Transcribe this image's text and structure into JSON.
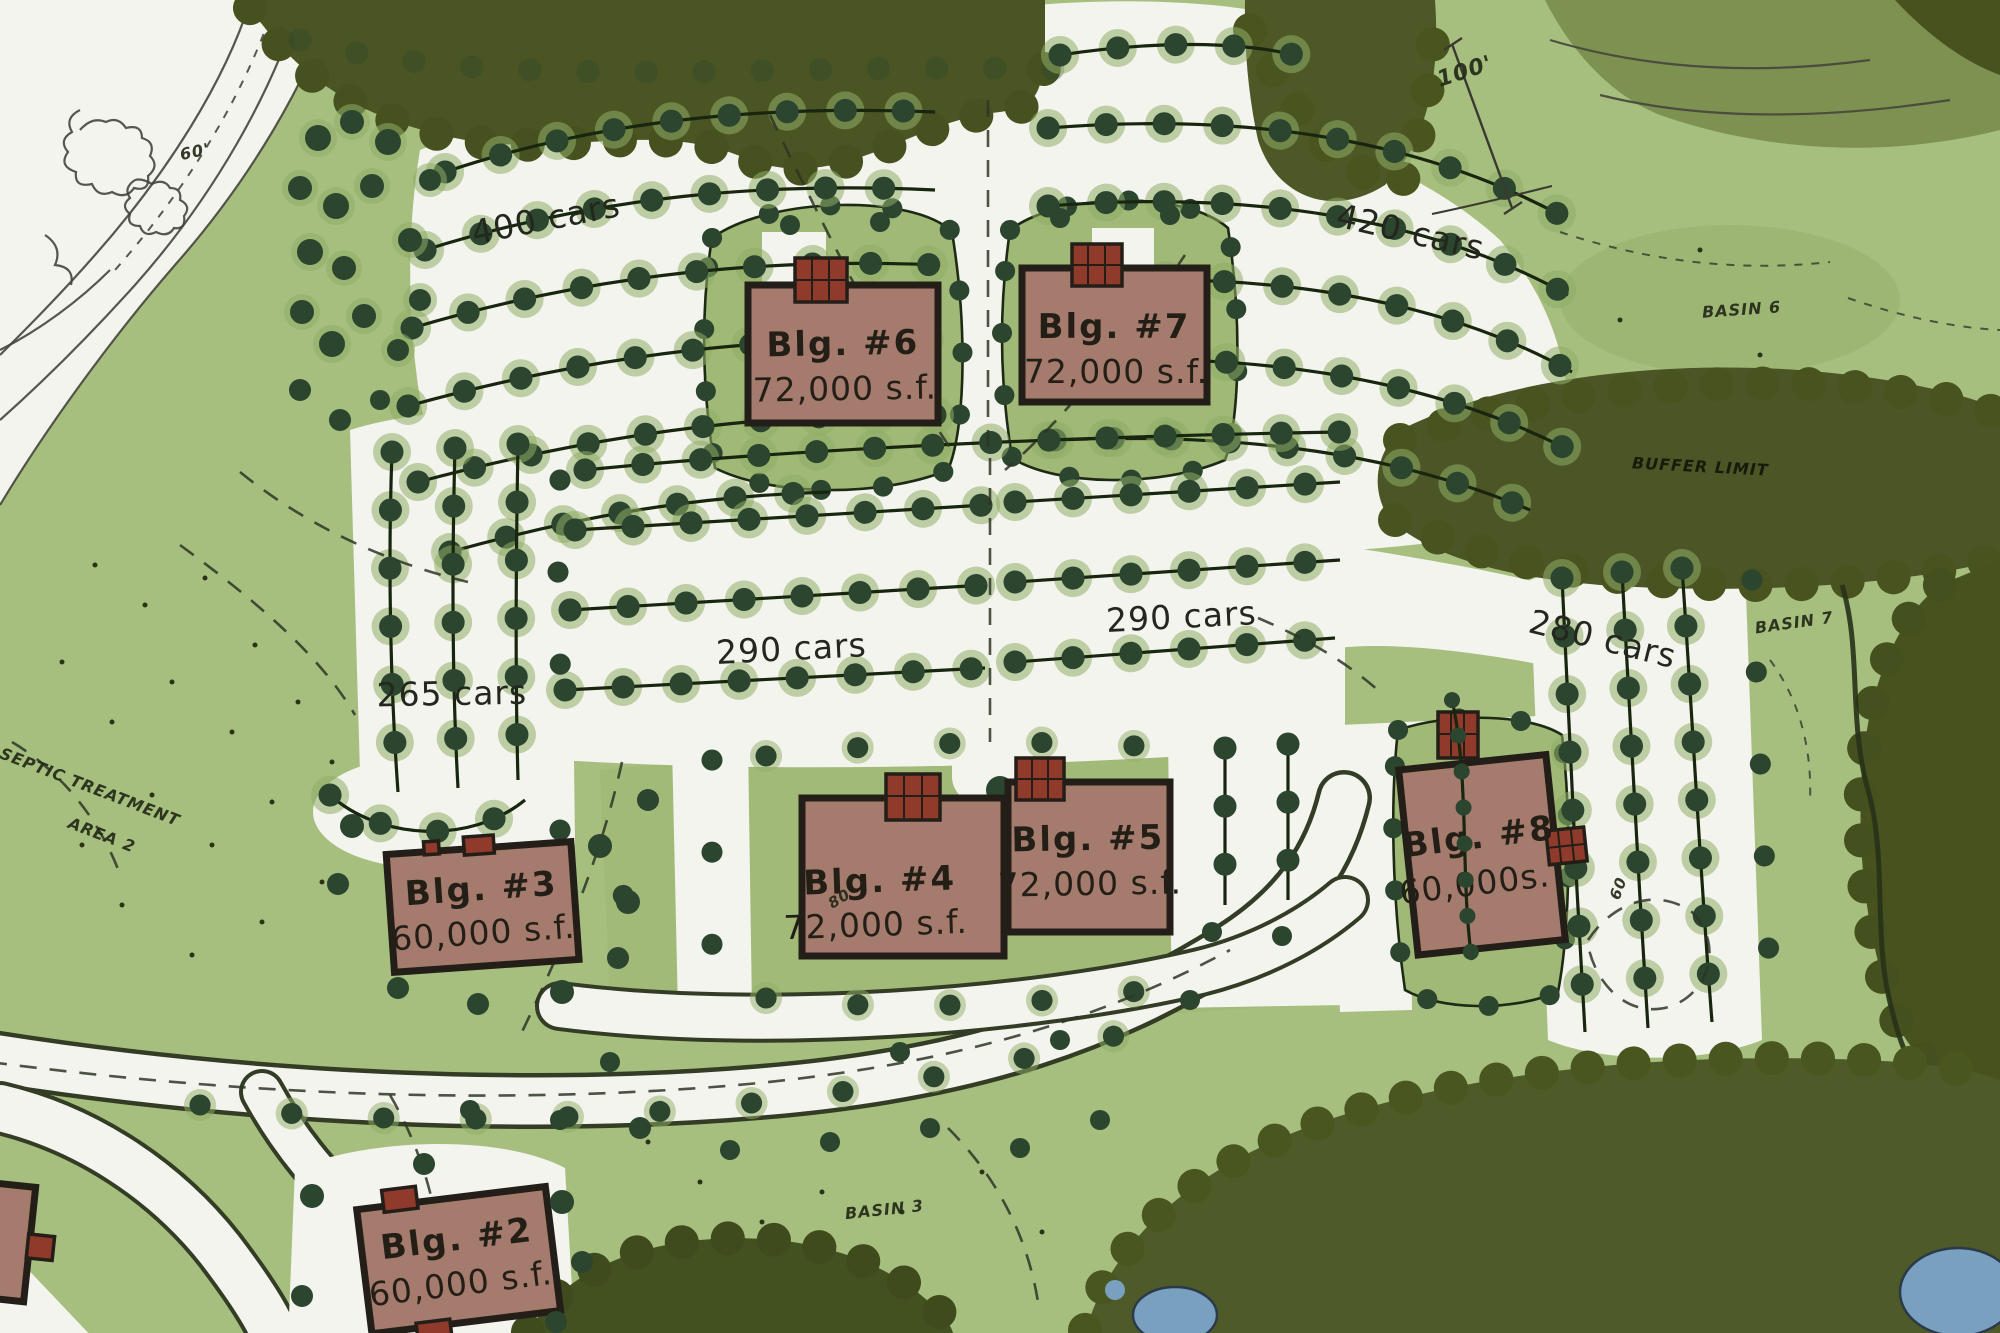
{
  "map": {
    "buildings": [
      {
        "name": "Blg. #2",
        "size": "60,000 s.f."
      },
      {
        "name": "Blg. #3",
        "size": "60,000 s.f."
      },
      {
        "name": "Blg. #4",
        "size": "72,000 s.f."
      },
      {
        "name": "Blg. #5",
        "size": "72,000 s.f."
      },
      {
        "name": "Blg. #6",
        "size": "72,000 s.f."
      },
      {
        "name": "Blg. #7",
        "size": "72,000 s.f."
      },
      {
        "name": "Blg. #8",
        "size": "60,000s."
      }
    ],
    "parking_labels": [
      {
        "label": "400 cars"
      },
      {
        "label": "420 cars"
      },
      {
        "label": "290 cars"
      },
      {
        "label": "290 cars"
      },
      {
        "label": "265 cars"
      },
      {
        "label": "280 cars"
      }
    ],
    "annotations": {
      "septic_line1": "SEPTIC TREATMENT",
      "septic_line2": "AREA 2",
      "basin6": "BASIN 6",
      "basin7": "BASIN 7",
      "basin3": "BASIN 3",
      "buffer": "BUFFER LIMIT",
      "dim_100": "100'",
      "contour_60": "60'",
      "dim_80": "80",
      "dim_60": "60"
    },
    "colors": {
      "grass": "#a6bf7e",
      "forest": "#4a5523",
      "paper": "#f4f4ef",
      "building": "#a57b6e",
      "roof_core": "#8f3a2a",
      "tree": "#2b452f",
      "water": "#7aa0c0",
      "ink": "#23271e"
    }
  }
}
